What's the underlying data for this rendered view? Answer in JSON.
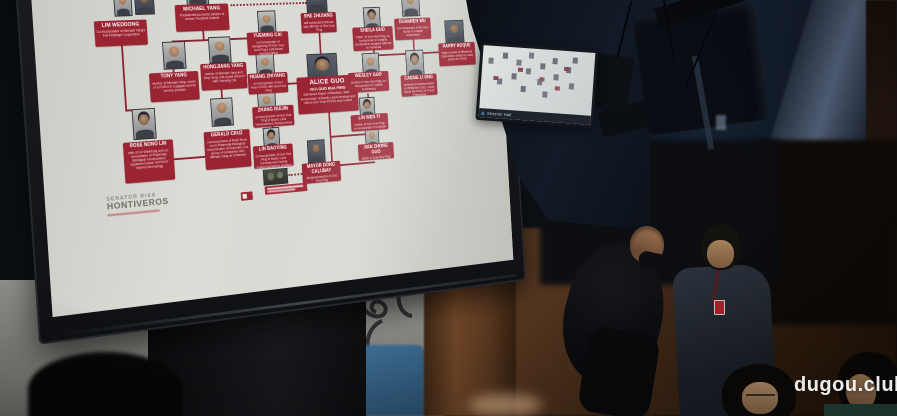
{
  "watermark": {
    "text": "dugou.club"
  },
  "slide": {
    "logo": {
      "line1": "Senator Risa",
      "line2": "Hontiveros"
    },
    "colors": {
      "accent_red": "#9b2433",
      "slide_bg": "#d9dad3"
    },
    "nodes": [
      {
        "name": "LIM WEDDONG",
        "desc": "Co-incorporator of Michael Yang's Full Holdings Corporation"
      },
      {
        "name": "MICHAEL YANG",
        "desc": "Presidential economic adviser of former President Duterte"
      },
      {
        "name": "SHE ZHIJIANG",
        "desc": "self-confessed Chinese spy with ties to Guo Hua Ping"
      },
      {
        "name": "YUEMING CAI",
        "desc": "co-incorporator of Hongsheng POGO; Guo Hua Ping's authorized representative"
      },
      {
        "name": "SHEILA GUO",
        "desc": "\"sister\" of Guo Hua Ping; co-incorporator in multiple businesses; escaped with her to Indonesia"
      },
      {
        "name": "DUANREN WU",
        "desc": "co-incorporator of the Guo family in multiple businesses"
      },
      {
        "name": "TONY YANG",
        "desc": "brother of Michael Yang; owner of a POGO in Cagayan and its service provider"
      },
      {
        "name": "HONGJIANG YANG",
        "desc": "mother of Michael Yang and Tony Yang; has a joint account with Yueming Cai"
      },
      {
        "name": "HUANG ZHIYANG",
        "desc": "co-incorporator of Zun Yuan POGO with Guo Hua Ping"
      },
      {
        "name": "ALICE GUO",
        "sub": "AKA GUO HUA PING",
        "desc": "dismissed Mayor of Bamban, Tarlac; incorporator of Baofu Land Development where Zun Yuan POGO was hosted"
      },
      {
        "name": "WESLEY GUO",
        "desc": "brother of Guo Hua Ping; co-incorporator in multiple businesses"
      },
      {
        "name": "HARRY ROQUE",
        "desc": "legal counsel of Whirlwind Corporation; linked to Lucky South 99 POGO"
      },
      {
        "name": "CASSIE LI ONG",
        "desc": "authorized representative of Whirlwind Corp.; Lucky South 99 POGO in Porac, Pampanga"
      },
      {
        "name": "ROSE NONO LIN",
        "desc": "wife of Lin Weddong and co-incorporator of Pharmally Biological Incorporated; registered owner of POGO internet technology"
      },
      {
        "name": "GERALD CRUZ",
        "desc": "co-incorporator of Rose Nono Lin in Pharmally Biological Incorporated; incorporator of a group of companies with Michael Yang as Chairman"
      },
      {
        "name": "ZHANG RUIJIN",
        "desc": "co-incorporator of Guo Hua Ping in Baofu Land Development; facing money laundering charges"
      },
      {
        "name": "LIN BAOYING",
        "desc": "co-incorporator of Guo Hua Ping in Baofu Land Development; facing money laundering charges"
      },
      {
        "name": "LIN WEN YI",
        "desc": "mother of Guo Hua Ping; co-incorporator in multiple businesses"
      },
      {
        "name": "JIAN ZHONG GUO",
        "desc": "father of Guo Hua Ping; co-incorporator in multiple businesses"
      },
      {
        "name": "MAYOR DONG CALUBAY",
        "desc": "alleged protector of Guo Hua Ping"
      }
    ]
  },
  "mini_screen": {
    "caption": "Session Hall"
  }
}
